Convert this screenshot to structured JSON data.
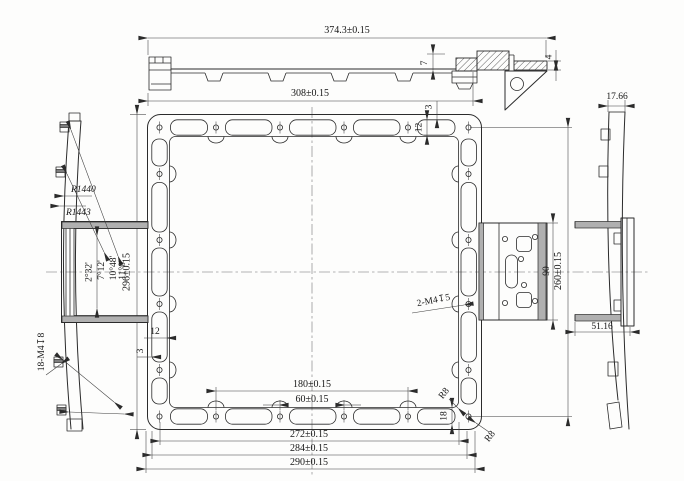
{
  "title": "frame-part-engineering-drawing",
  "colors": {
    "background": "#fdfdfc",
    "ink": "#2b2b2b",
    "fill_gray": "#b0b0b0"
  },
  "top_view": {
    "total_length": "374.3±0.15",
    "body_length": "308±0.15",
    "step_height": "7",
    "flange_thickness": "4"
  },
  "front_view": {
    "wall_top": "3",
    "slot_width_top": "12",
    "frame_height": "296±0.15",
    "slot_width_left": "12",
    "wall_left": "3",
    "hole_span_mid": "180±0.15",
    "hole_span_inner": "60±0.15",
    "span_outer_1": "272±0.15",
    "span_outer_2": "284±0.15",
    "span_outer_3": "290±0.15",
    "slot_length": "18",
    "fillet_radius_1": "R8",
    "fillet_radius_2": "R8",
    "thread_note": "2-M4↧5"
  },
  "left_view": {
    "radius_outer": "R1440",
    "radius_inner": "R1443",
    "angle_1": "2°32'",
    "angle_2": "7°12'",
    "angle_3": "10°48'",
    "angle_4": "11°0'",
    "thread_note": "18-M4↧8"
  },
  "side_plate_view": {
    "plate_height": "90",
    "hole_row_span": "260±0.15"
  },
  "right_view": {
    "top_width": "17.66",
    "bottom_width": "51.16"
  }
}
